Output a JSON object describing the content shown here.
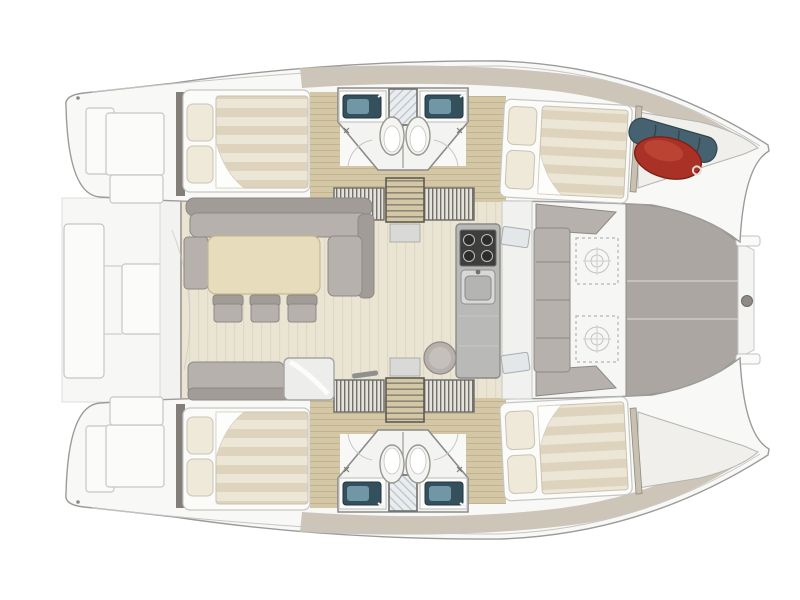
{
  "image": {
    "type": "boat-floor-plan",
    "subject": "catamaran interior layout",
    "view": "top-down",
    "orientation": "bow-right-stern-left",
    "visible_text": ""
  },
  "colors": {
    "page-bg": "#ffffff",
    "hull-fill": "#f8f8f6",
    "hull-stroke": "#9b9b99",
    "soft-stroke": "#c6c6c4",
    "deck-taupe": "#c8c0b1",
    "deck-taupe-light": "#ddd6c9",
    "wood-floor": "#d3c7a5",
    "wood-grain": "#b9ac88",
    "salon-floor": "#eae4d3",
    "table-wood": "#e7dcbc",
    "cushion": "#b7b1ad",
    "cushion-dark": "#a29c98",
    "cushion-stroke": "#8e8984",
    "white-furniture": "#fbfbf9",
    "pillow": "#efe9d9",
    "duvet-a": "#ded4bd",
    "duvet-b": "#ece6d6",
    "steel": "#b9b9b7",
    "steel-dark": "#8f8f8d",
    "stove": "#3e3e3c",
    "sink-teal": "#33505c",
    "sink-teal-light": "#7da2b2",
    "toilet": "#f4f4f2",
    "tramp": "#aca6a2",
    "tramp-seam": "#c6c1bd",
    "fender-red": "#a93125",
    "fender-red-light": "#c24b3a",
    "gear-blue": "#46616f",
    "wall-dark": "#6e6860",
    "hatch-line": "#b3b3b1",
    "bathroom-floor": "#f3f3f1"
  },
  "vessel": {
    "type": "sailing-catamaran",
    "hulls": [
      {
        "name": "port-hull",
        "position": "top",
        "compartments": [
          {
            "name": "swim-platform",
            "features": [
              "transom-steps"
            ]
          },
          {
            "name": "aft-cabin",
            "features": [
              "double-bed",
              "two-pillows",
              "striped-duvet",
              "turned-sheet"
            ]
          },
          {
            "name": "bathroom-block",
            "features": [
              "vanity-sink-aft",
              "vanity-sink-forward",
              "central-shower",
              "two-toilets",
              "door-swings"
            ]
          },
          {
            "name": "companionway",
            "features": [
              "stairs-to-salon",
              "wardrobe-aft",
              "wardrobe-forward"
            ]
          },
          {
            "name": "forward-cabin",
            "features": [
              "double-bed",
              "two-pillows",
              "striped-duvet"
            ]
          },
          {
            "name": "bow-locker",
            "contents": [
              "red-fender",
              "blue-gear-roll"
            ]
          }
        ]
      },
      {
        "name": "starboard-hull",
        "position": "bottom",
        "compartments": [
          {
            "name": "swim-platform",
            "features": [
              "transom-steps"
            ]
          },
          {
            "name": "aft-cabin",
            "features": [
              "double-bed",
              "two-pillows",
              "striped-duvet",
              "turned-sheet"
            ]
          },
          {
            "name": "bathroom-block",
            "features": [
              "vanity-sink-aft",
              "vanity-sink-forward",
              "central-shower",
              "two-toilets",
              "door-swings"
            ]
          },
          {
            "name": "companionway",
            "features": [
              "stairs-to-salon",
              "wardrobe-aft",
              "wardrobe-forward"
            ]
          },
          {
            "name": "forward-cabin",
            "features": [
              "double-bed",
              "two-pillows",
              "striped-duvet"
            ]
          },
          {
            "name": "bow-locker",
            "contents": []
          }
        ]
      }
    ],
    "salon": {
      "position": "center-bridgedeck",
      "features": [
        "l-shaped-settee",
        "rectangular-dining-table",
        "three-stools",
        "aft-bench",
        "cooler-box",
        "galley-counter",
        "four-burner-stove",
        "galley-sink",
        "round-stool",
        "aft-sliding-door",
        "forward-door"
      ]
    },
    "forward_cockpit": {
      "features": [
        "u-shaped-lounge-seating",
        "deck-hatch-upper",
        "deck-hatch-lower"
      ]
    },
    "trampoline": {
      "panels": 3,
      "features": [
        "lacing-strip",
        "bow-bridle-fitting",
        "attachment-tabs"
      ]
    },
    "aft_platform": {
      "features": [
        "davit-platform",
        "cockpit-module"
      ]
    }
  }
}
